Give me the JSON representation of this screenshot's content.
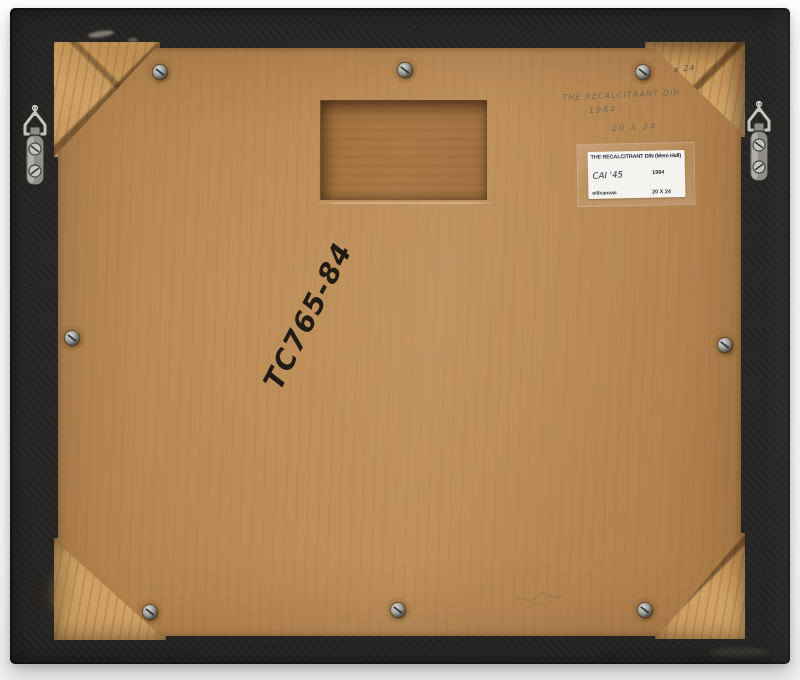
{
  "pencil_inscription": {
    "line1": "THE RECALCITRANT DIN",
    "line2": "1984",
    "line3": "20 X 24"
  },
  "corner_note": "x 24.",
  "label": {
    "title": "THE RECALCITRANT DIN (Mem Hall)",
    "year": "1984",
    "accession_handwritten": "CAI '45",
    "medium": "oil/canvas",
    "dimensions": "20 X 24"
  },
  "marker_code": "TC765-84",
  "colors": {
    "frame_black": "#242220",
    "backing_tan": "#b78750",
    "recess_tan": "#a87a46",
    "wood_tan": "#cfa368",
    "label_white": "#f4f2ee",
    "pencil_gray": "#6e6254",
    "marker_black": "#201b14",
    "hardware_silver": "#b5b3ae"
  }
}
